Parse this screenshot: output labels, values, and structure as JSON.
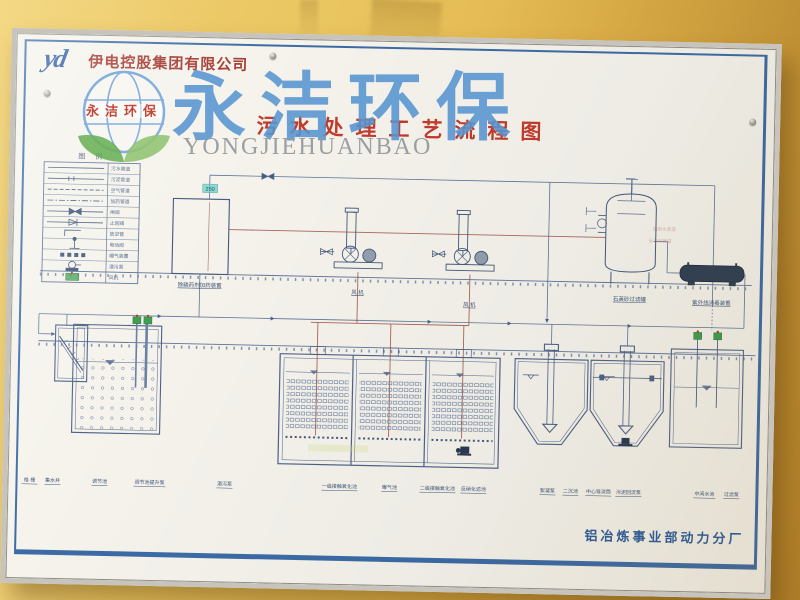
{
  "header": {
    "logo_text": "yd",
    "company_name": "伊电控股集团有限公司"
  },
  "title": "污水处理工艺流程图",
  "watermark": {
    "brand_cn": "永洁环保",
    "brand_en": "YONGJIEHUANBAO",
    "logo_ribbon_text": "永洁环保"
  },
  "legend": {
    "title": "图 例",
    "rows": [
      {
        "symbol": "solid-line",
        "label": "污水管道"
      },
      {
        "symbol": "tick-line",
        "label": "污泥管道"
      },
      {
        "symbol": "dashed-line",
        "label": "空气管道"
      },
      {
        "symbol": "dashdot-line",
        "label": "加药管道"
      },
      {
        "symbol": "gate-valve",
        "label": "闸阀"
      },
      {
        "symbol": "check-valve",
        "label": "止回阀"
      },
      {
        "symbol": "vent-pipe",
        "label": "放空管"
      },
      {
        "symbol": "motor-valve",
        "label": "电动阀"
      },
      {
        "symbol": "aerator",
        "label": "曝气装置"
      },
      {
        "symbol": "submersible-pump",
        "label": "潜污泵"
      },
      {
        "symbol": "blower",
        "label": "风机"
      }
    ]
  },
  "diagram": {
    "equipment_labels": {
      "dosing_device": "除磷药剂加药装置",
      "blower_1": "风 机",
      "blower_2": "风 机",
      "sand_filter": "石英砂过滤罐",
      "uv_disinfection": "紫外线消毒装置",
      "pipe_tag": "250",
      "pipe_note_1": "回用水管道",
      "pipe_note_2": "反冲洗管道"
    },
    "bottom_labels": [
      "格 栅",
      "集水井",
      "调节池",
      "调节池提升泵",
      "潜污泵",
      "一级接触氧化池",
      "曝气池",
      "二级接触氧化池",
      "反硝化滤池",
      "絮凝泵",
      "二沉池",
      "中心导流筒",
      "污泥回流泵",
      "中间水池",
      "过滤泵"
    ]
  },
  "footer": {
    "plant_name": "铝冶炼事业部动力分厂"
  },
  "colors": {
    "wall": "#e3b54a",
    "poster": "#f5f3ec",
    "border_blue": "#3c6ba6",
    "line_blue": "#5d7499",
    "tank_blue": "#4d6289",
    "accent_red": "#a43a31",
    "title_red": "#c23b2c",
    "watermark_blue": "#5795d0",
    "watermark_gray": "#94999c",
    "pump_green": "#3f9e4f",
    "uv_dark": "#2e3f55",
    "air_pipe_red": "#9e4f44"
  }
}
